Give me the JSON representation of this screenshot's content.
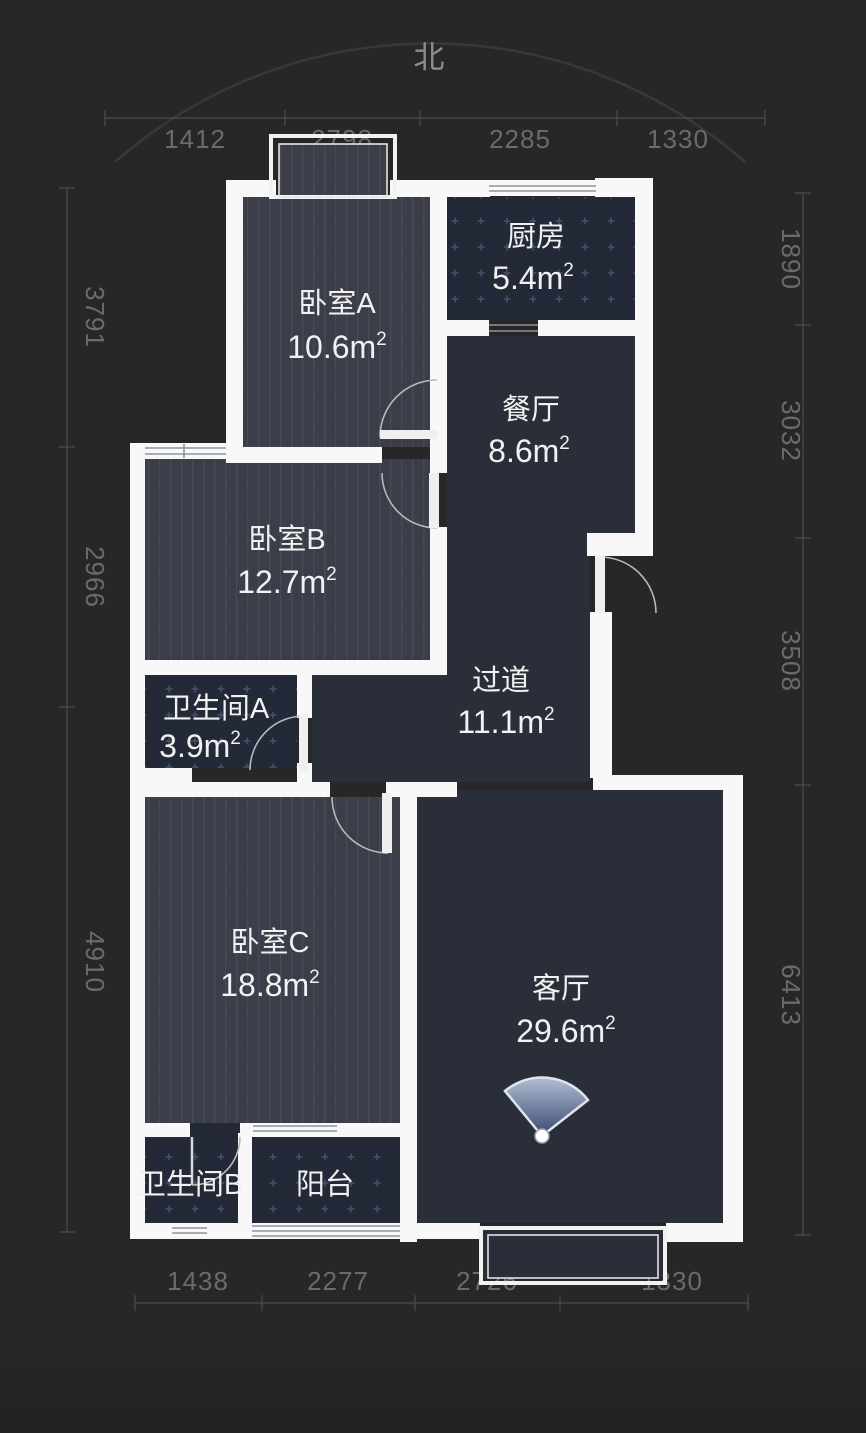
{
  "compass": {
    "north_label": "北"
  },
  "rooms": {
    "bedroom_a": {
      "name": "卧室A",
      "area_main": "10.6m",
      "area_sup": "2"
    },
    "kitchen": {
      "name": "厨房",
      "area_main": "5.4m",
      "area_sup": "2"
    },
    "dining": {
      "name": "餐厅",
      "area_main": "8.6m",
      "area_sup": "2"
    },
    "bedroom_b": {
      "name": "卧室B",
      "area_main": "12.7m",
      "area_sup": "2"
    },
    "bathroom_a": {
      "name": "卫生间A",
      "area_main": "3.9m",
      "area_sup": "2"
    },
    "corridor": {
      "name": "过道",
      "area_main": "11.1m",
      "area_sup": "2"
    },
    "bedroom_c": {
      "name": "卧室C",
      "area_main": "18.8m",
      "area_sup": "2"
    },
    "living": {
      "name": "客厅",
      "area_main": "29.6m",
      "area_sup": "2"
    },
    "bathroom_b": {
      "name": "卫生间B"
    },
    "balcony": {
      "name": "阳台"
    }
  },
  "dimensions": {
    "top": [
      "1412",
      "2798",
      "2285",
      "1330"
    ],
    "bottom": [
      "1438",
      "2277",
      "2726",
      "1330"
    ],
    "left": [
      "3791",
      "2966",
      "4910"
    ],
    "right": [
      "1890",
      "3032",
      "3508",
      "6413"
    ]
  },
  "colors": {
    "background": "#272727",
    "wall": "#f8f8f8",
    "floor_open": "#2a2e38",
    "floor_bedroom": "#3b3e49",
    "floor_tile": "#232936",
    "dimension_text": "#6b6b6b",
    "camera_fan_blue": "#41537b"
  }
}
